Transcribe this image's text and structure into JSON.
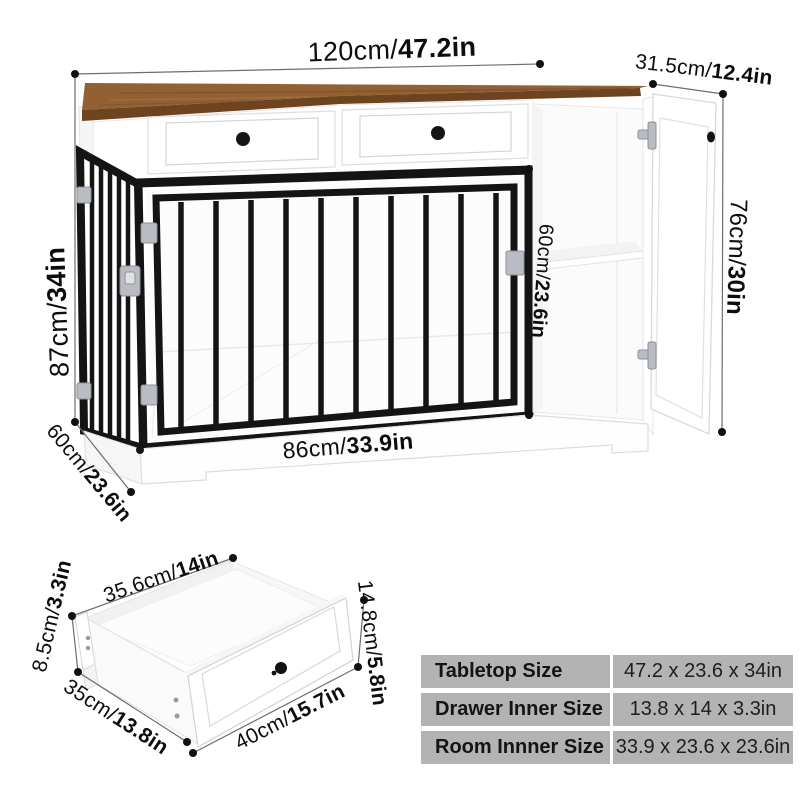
{
  "main_diagram": {
    "dimensions": {
      "top_width": {
        "metric": "120cm/",
        "imperial": "47.2in"
      },
      "top_depth": {
        "metric": "31.5cm/",
        "imperial": "12.4in"
      },
      "left_height": {
        "metric": "87cm/",
        "imperial": "34in"
      },
      "bottom_depth": {
        "metric": "60cm/",
        "imperial": "23.6in"
      },
      "inner_width": {
        "metric": "86cm/",
        "imperial": "33.9in"
      },
      "inner_height": {
        "metric": "60cm/",
        "imperial": "23.6in"
      },
      "right_height": {
        "metric": "76cm/",
        "imperial": "30in"
      }
    }
  },
  "drawer_diagram": {
    "dimensions": {
      "top_width": {
        "metric": "35.6cm/",
        "imperial": "14in"
      },
      "left_height": {
        "metric": "8.5cm/",
        "imperial": "3.3in"
      },
      "left_depth": {
        "metric": "35cm/",
        "imperial": "13.8in"
      },
      "front_width": {
        "metric": "40cm/",
        "imperial": "15.7in"
      },
      "right_height": {
        "metric": "14.8cm/",
        "imperial": "5.8in"
      }
    }
  },
  "spec_table": {
    "rows": [
      {
        "label": "Tabletop Size",
        "value": "47.2 x 23.6 x 34in"
      },
      {
        "label": "Drawer Inner Size",
        "value": "13.8 x 14 x 3.3in"
      },
      {
        "label": "Room Innner Size",
        "value": "33.9 x 23.6 x 23.6in"
      }
    ]
  },
  "colors": {
    "wood_top": "#916033",
    "wood_edge": "#6e431f",
    "frame_black": "#141414",
    "hardware_silver": "#b9bcc2",
    "table_cell_bg": "#b3b3b3",
    "dim_line": "#6e6e6e",
    "text": "#0d0d0d",
    "background": "#ffffff"
  }
}
